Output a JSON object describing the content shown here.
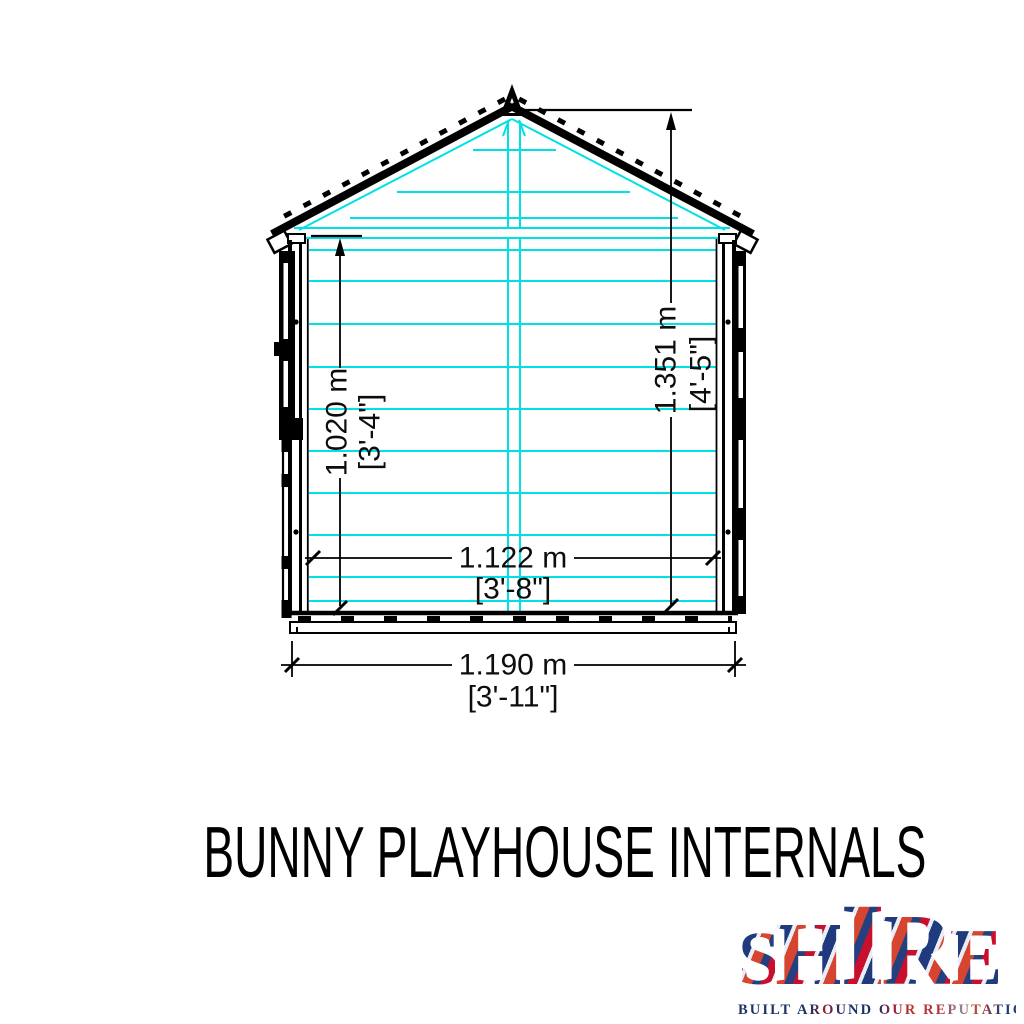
{
  "title": {
    "text": "BUNNY PLAYHOUSE INTERNALS"
  },
  "drawing": {
    "name": "playhouse-front-elevation-internals",
    "dimensions": {
      "ridge_height": {
        "metric": "1.351 m",
        "imperial": "[4'-5\"]"
      },
      "internal_height": {
        "metric": "1.020 m",
        "imperial": "[3'-4\"]"
      },
      "internal_width": {
        "metric": "1.122 m",
        "imperial": "[3'-8\"]"
      },
      "external_width": {
        "metric": "1.190 m",
        "imperial": "[3'-11\"]"
      }
    },
    "colors": {
      "internal_lines": "#00e1e6",
      "outline": "#000000"
    }
  },
  "logo": {
    "wordmark": "SHIRE",
    "letters": [
      "S",
      "H",
      "I",
      "R",
      "E"
    ],
    "tagline": "BUILT AROUND OUR REPUTATION",
    "colors": {
      "navy": "#21356f",
      "red": "#c8102e",
      "silver": "#dce3ee"
    }
  }
}
